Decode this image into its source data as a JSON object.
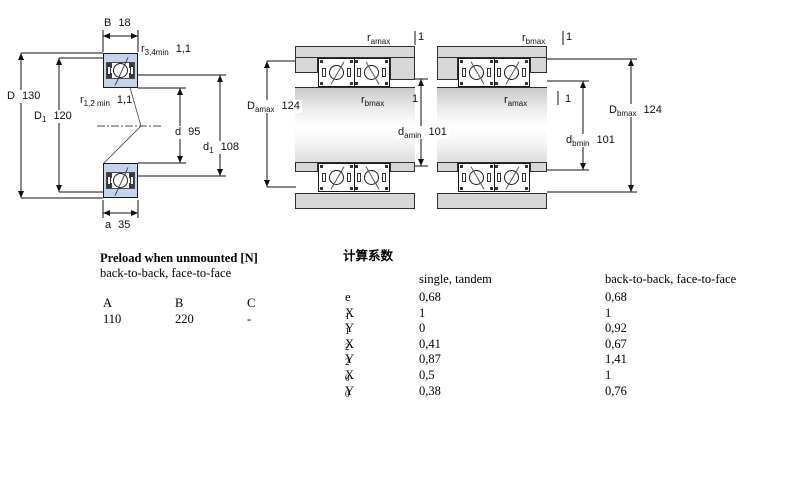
{
  "colors": {
    "bearing_fill": "#c5d3ee",
    "steel_gray": "#d7d7d7"
  },
  "figures": {
    "left": {
      "labels": {
        "B": {
          "sym": "B",
          "sub": "",
          "val": "18"
        },
        "r34": {
          "sym": "r",
          "sub": "3,4min",
          "val": "1,1"
        },
        "D": {
          "sym": "D",
          "sub": "",
          "val": "130"
        },
        "D1": {
          "sym": "D",
          "sub": "1",
          "val": "120"
        },
        "r12": {
          "sym": "r",
          "sub": "1,2 min",
          "val": "1,1"
        },
        "d": {
          "sym": "d",
          "sub": "",
          "val": "95"
        },
        "d1": {
          "sym": "d",
          "sub": "1",
          "val": "108"
        },
        "a": {
          "sym": "a",
          "sub": "",
          "val": "35"
        }
      }
    },
    "middle": {
      "labels": {
        "ramax": {
          "sym": "r",
          "sub": "amax",
          "val": "1"
        },
        "Damax": {
          "sym": "D",
          "sub": "amax",
          "val": "124"
        },
        "rbmax": {
          "sym": "r",
          "sub": "bmax",
          "val": "1"
        },
        "damin": {
          "sym": "d",
          "sub": "amin",
          "val": "101"
        }
      }
    },
    "right": {
      "labels": {
        "rbmax": {
          "sym": "r",
          "sub": "bmax",
          "val": "1"
        },
        "ramax": {
          "sym": "r",
          "sub": "amax",
          "val": "1"
        },
        "Dbmax": {
          "sym": "D",
          "sub": "bmax",
          "val": "124"
        },
        "dbmin": {
          "sym": "d",
          "sub": "bmin",
          "val": "101"
        }
      }
    }
  },
  "preload_table": {
    "title": "Preload when unmounted [N]",
    "subtitle": "back-to-back, face-to-face",
    "columns": [
      "A",
      "B",
      "C"
    ],
    "values": [
      "110",
      "220",
      "-"
    ]
  },
  "factors_table": {
    "title": "计算系数",
    "col1_header": "single, tandem",
    "col2_header": "back-to-back, face-to-face",
    "rows": [
      {
        "sym": "e",
        "sub": "",
        "single": "0,68",
        "paired": "0,68"
      },
      {
        "sym": "X",
        "sub": "1",
        "single": "1",
        "paired": "1"
      },
      {
        "sym": "Y",
        "sub": "1",
        "single": "0",
        "paired": "0,92"
      },
      {
        "sym": "X",
        "sub": "2",
        "single": "0,41",
        "paired": "0,67"
      },
      {
        "sym": "Y",
        "sub": "2",
        "single": "0,87",
        "paired": "1,41"
      },
      {
        "sym": "X",
        "sub": "0",
        "single": "0,5",
        "paired": "1"
      },
      {
        "sym": "Y",
        "sub": "0",
        "single": "0,38",
        "paired": "0,76"
      }
    ]
  }
}
